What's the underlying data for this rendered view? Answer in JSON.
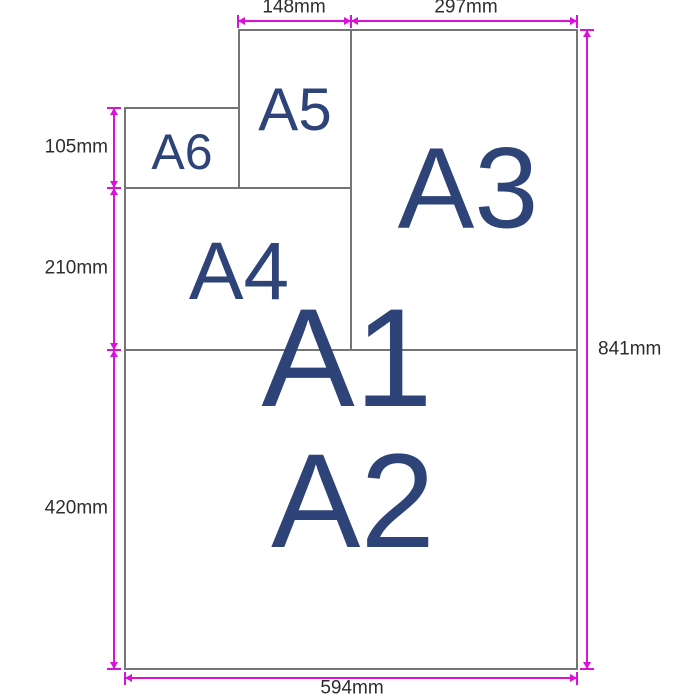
{
  "colors": {
    "background": "#ffffff",
    "paper_fill": "#ffffff",
    "paper_border": "#757575",
    "paper_label": "#2e4377",
    "dimension_line": "#d911d9",
    "dimension_text": "#2d2d2d"
  },
  "papers": {
    "a1": {
      "label": "A1"
    },
    "a2": {
      "label": "A2"
    },
    "a3": {
      "label": "A3"
    },
    "a4": {
      "label": "A4"
    },
    "a5": {
      "label": "A5"
    },
    "a6": {
      "label": "A6"
    }
  },
  "dimensions": {
    "d148": {
      "label": "148mm",
      "edge": "top"
    },
    "d297": {
      "label": "297mm",
      "edge": "top"
    },
    "d105": {
      "label": "105mm",
      "edge": "left"
    },
    "d210": {
      "label": "210mm",
      "edge": "left"
    },
    "d420": {
      "label": "420mm",
      "edge": "left"
    },
    "d841": {
      "label": "841mm",
      "edge": "right"
    },
    "d594": {
      "label": "594mm",
      "edge": "bottom"
    }
  }
}
